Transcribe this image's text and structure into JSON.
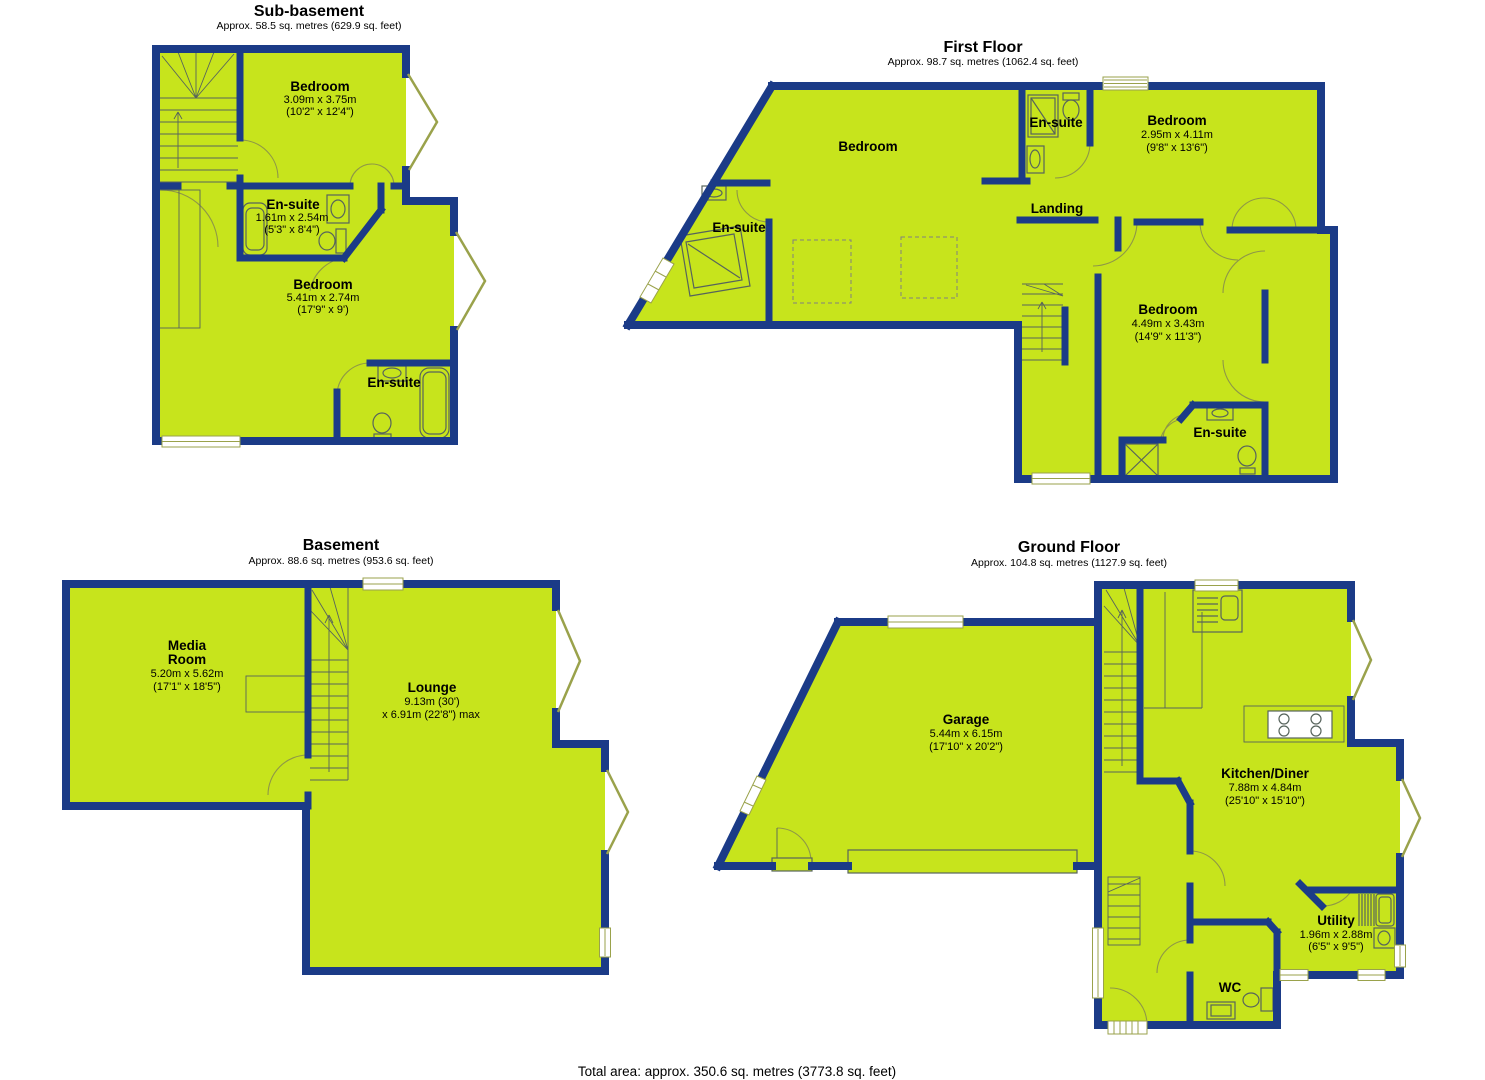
{
  "page": {
    "total_area": "Total area: approx. 350.6 sq. metres (3773.8 sq. feet)"
  },
  "colors": {
    "room_fill": "#c7e41c",
    "wall": "#1b3b87",
    "window_line": "#9aa24b",
    "fixture_line": "#57645c",
    "door_line": "#8e9747"
  },
  "floors": [
    {
      "name": "Sub-basement",
      "area": "Approx. 58.5 sq. metres (629.9 sq. feet)",
      "rooms": [
        {
          "name": "Bedroom",
          "dim_m": "3.09m x 3.75m",
          "dim_ft": "(10'2\" x 12'4\")"
        },
        {
          "name": "En-suite",
          "dim_m": "1.61m x 2.54m",
          "dim_ft": "(5'3\" x 8'4\")"
        },
        {
          "name": "Bedroom",
          "dim_m": "5.41m x 2.74m",
          "dim_ft": "(17'9\" x 9')"
        },
        {
          "name": "En-suite"
        }
      ]
    },
    {
      "name": "First Floor",
      "area": "Approx. 98.7 sq. metres (1062.4 sq. feet)",
      "rooms": [
        {
          "name": "Bedroom"
        },
        {
          "name": "En-suite"
        },
        {
          "name": "Bedroom",
          "dim_m": "2.95m x 4.11m",
          "dim_ft": "(9'8\" x 13'6\")"
        },
        {
          "name": "En-suite"
        },
        {
          "name": "Landing"
        },
        {
          "name": "Bedroom",
          "dim_m": "4.49m x 3.43m",
          "dim_ft": "(14'9\" x 11'3\")"
        },
        {
          "name": "En-suite"
        }
      ]
    },
    {
      "name": "Basement",
      "area": "Approx. 88.6 sq. metres (953.6 sq. feet)",
      "rooms": [
        {
          "name_lines": [
            "Media",
            "Room"
          ],
          "dim_m": "5.20m x 5.62m",
          "dim_ft": "(17'1\" x 18'5\")"
        },
        {
          "name": "Lounge",
          "dim_m": "9.13m (30')",
          "dim_ft": "x 6.91m (22'8\") max"
        }
      ]
    },
    {
      "name": "Ground Floor",
      "area": "Approx. 104.8 sq. metres (1127.9 sq. feet)",
      "rooms": [
        {
          "name": "Garage",
          "dim_m": "5.44m x 6.15m",
          "dim_ft": "(17'10\" x 20'2\")"
        },
        {
          "name": "Kitchen/Diner",
          "dim_m": "7.88m x 4.84m",
          "dim_ft": "(25'10\" x 15'10\")"
        },
        {
          "name": "Utility",
          "dim_m": "1.96m x 2.88m",
          "dim_ft": "(6'5\" x 9'5\")"
        },
        {
          "name": "WC"
        }
      ]
    }
  ]
}
